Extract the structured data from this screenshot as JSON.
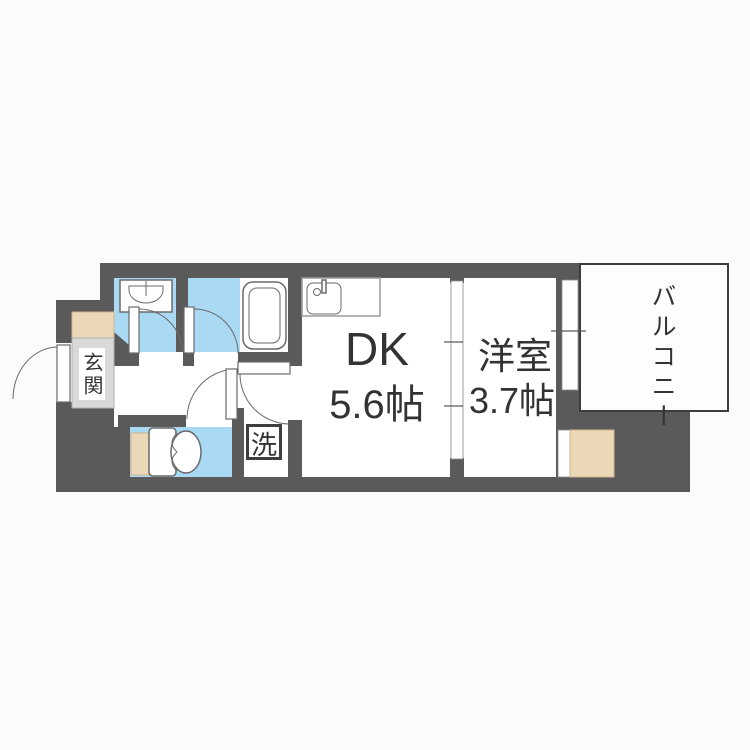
{
  "floorplan": {
    "labels": {
      "entrance": "玄関",
      "dining_kitchen": "DK",
      "dining_kitchen_size": "5.6帖",
      "western_room": "洋室",
      "western_room_size": "3.7帖",
      "balcony": "バルコニー",
      "laundry": "洗"
    },
    "colors": {
      "wall": "#5a5a5a",
      "wet_area_floor": "#a9d9f3",
      "entrance_floor": "#d9d9d9",
      "wood_accent": "#ead8b7",
      "room_floor": "#ffffff",
      "background": "#fbfbfb",
      "text": "#333333"
    }
  }
}
